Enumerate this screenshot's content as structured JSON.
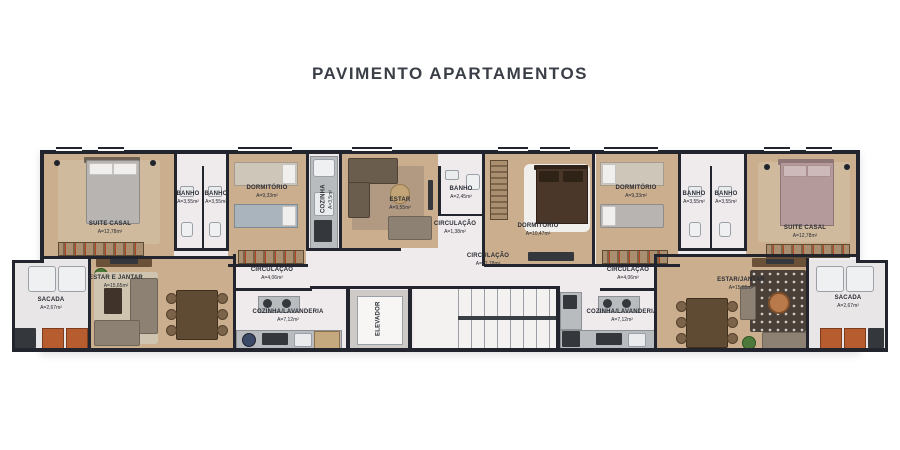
{
  "title": "PAVIMENTO APARTAMENTOS",
  "colors": {
    "wall": "#23252e",
    "wood_floor": "#cbae8d",
    "light_floor": "#efeaec",
    "balcony_floor": "#e9e6e7",
    "title_text": "#3a3e46",
    "label_text": "#2a2d35",
    "accent_planter": "#b65c2e"
  },
  "rooms": [
    {
      "name": "SUITE CASAL",
      "area": "A=12,78m²"
    },
    {
      "name": "BANHO",
      "area": "A=3,55m²"
    },
    {
      "name": "BANHO",
      "area": "A=3,55m²"
    },
    {
      "name": "DORMITÓRIO",
      "area": "A=9,33m²"
    },
    {
      "name": "COZINHA",
      "area": "A=3,5m²"
    },
    {
      "name": "ESTAR",
      "area": "A=9,55m²"
    },
    {
      "name": "BANHO",
      "area": "A=2,45m²"
    },
    {
      "name": "CIRCULAÇÃO",
      "area": "A=1,38m²"
    },
    {
      "name": "DORMITÓRIO",
      "area": "A=10,47m²"
    },
    {
      "name": "CIRCULAÇÃO",
      "area": "A=12,78m²"
    },
    {
      "name": "SACADA",
      "area": "A=2,67m²"
    },
    {
      "name": "ESTAR E JANTAR",
      "area": "A=15,65m²"
    },
    {
      "name": "CIRCULAÇÃO",
      "area": "A=4,06m²"
    },
    {
      "name": "COZINHA/LAVANDERIA",
      "area": "A=7,12m²"
    },
    {
      "name": "ELEVADOR"
    },
    {
      "name": "DORMITÓRIO",
      "area": "A=9,33m²"
    },
    {
      "name": "BANHO",
      "area": "A=3,55m²"
    },
    {
      "name": "BANHO",
      "area": "A=3,55m²"
    },
    {
      "name": "SUITE CASAL",
      "area": "A=12,78m²"
    },
    {
      "name": "CIRCULAÇÃO",
      "area": "A=4,06m²"
    },
    {
      "name": "COZINHA/LAVANDERIA",
      "area": "A=7,12m²"
    },
    {
      "name": "ESTAR/JANTAR",
      "area": "A=15,65m²"
    },
    {
      "name": "SACADA",
      "area": "A=2,67m²"
    }
  ],
  "furniture_icons": [
    "double-bed",
    "single-bed",
    "wardrobe",
    "sofa",
    "armchair",
    "coffee-table",
    "dining-table",
    "chair",
    "kitchen-counter",
    "stove",
    "sink",
    "toilet",
    "washer",
    "elevator",
    "staircase",
    "rug",
    "plant",
    "balcony-chair"
  ]
}
